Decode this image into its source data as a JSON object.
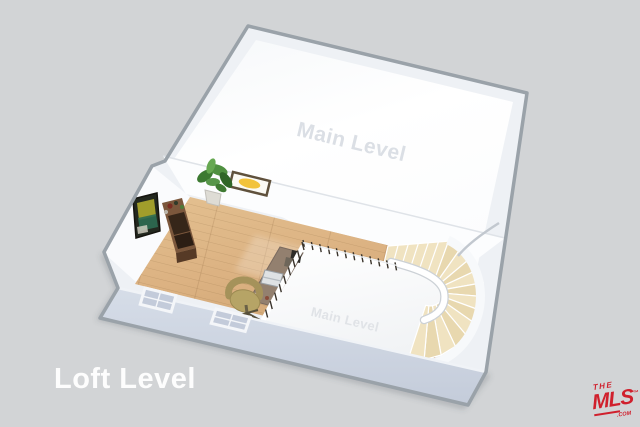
{
  "scene": {
    "description": "3D dollhouse-style floor plan rendering of a loft level overlooking a main level, with curved staircase",
    "background_color": "#d2d4d6"
  },
  "labels": {
    "floor_title": "Loft Level",
    "upper_room": "Main Level",
    "stairwell_room": "Main Level"
  },
  "logo": {
    "brand_top": "THE",
    "brand_main": "MLS",
    "trademark": "™",
    "suffix": ".COM",
    "color": "#d0202d"
  },
  "palette": {
    "background": "#d2d4d6",
    "wall_outline": "#9aa2a9",
    "wall_face": "#eef1f5",
    "interior_wall_white": "#fcfdfe",
    "floor_white": "#ffffff",
    "wood_floor": "#dcb282",
    "wood_floor_dark": "#c69c6c",
    "stair_tread": "#f0e3c1",
    "stair_tread_alt": "#e8d8af",
    "front_exterior_wall": "#cfd7e3",
    "railing_white": "#ffffff",
    "baluster_dark": "#39332b",
    "desk_brown": "#93806f",
    "console_brown": "#6e4c34",
    "chair_olive": "#b6a466",
    "plant_green": "#4e8f3d",
    "artwork_accent": "#f2c33c"
  },
  "objects": [
    {
      "label": "main-level-room"
    },
    {
      "label": "loft-wood-floor"
    },
    {
      "label": "stairwell-opening"
    },
    {
      "label": "curved-staircase"
    },
    {
      "label": "stair-railing-with-balusters"
    },
    {
      "label": "front-wall-window",
      "count": 2
    },
    {
      "label": "wall-artwork"
    },
    {
      "label": "potted-plant"
    },
    {
      "label": "media-console"
    },
    {
      "label": "tv-screen"
    },
    {
      "label": "desk-with-laptop"
    },
    {
      "label": "office-chair"
    },
    {
      "label": "small-floor-plant"
    }
  ]
}
